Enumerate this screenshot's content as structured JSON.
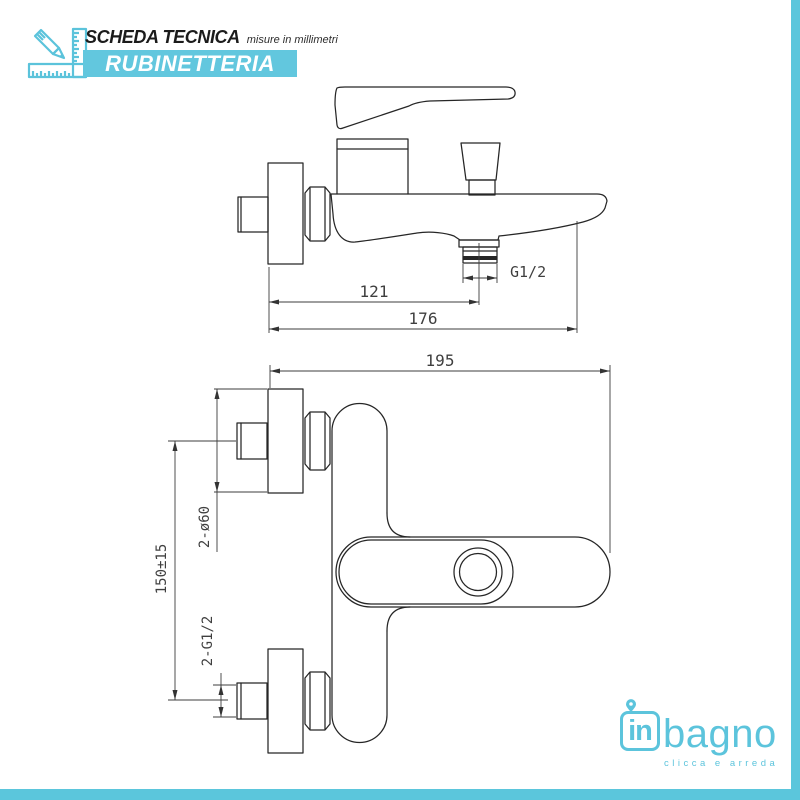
{
  "header": {
    "title": "SCHEDA TECNICA",
    "subtitle": "misure in millimetri",
    "category": "RUBINETTERIA"
  },
  "side_view": {
    "dim_wall_to_outlet": "121",
    "dim_wall_to_spout_end": "176",
    "outlet_thread": "G1/2"
  },
  "top_view": {
    "dim_total_depth": "195",
    "dim_inlet_distance": "150±15",
    "dim_flanges": "2-ø60",
    "dim_inlet_threads": "2-G1/2"
  },
  "logo": {
    "prefix": "in",
    "name": "bagno",
    "tagline": "clicca e arreda"
  },
  "colors": {
    "accent": "#5cc4dc",
    "band": "#62c7de",
    "line": "#262626",
    "dim_text": "#3f3f3f"
  }
}
